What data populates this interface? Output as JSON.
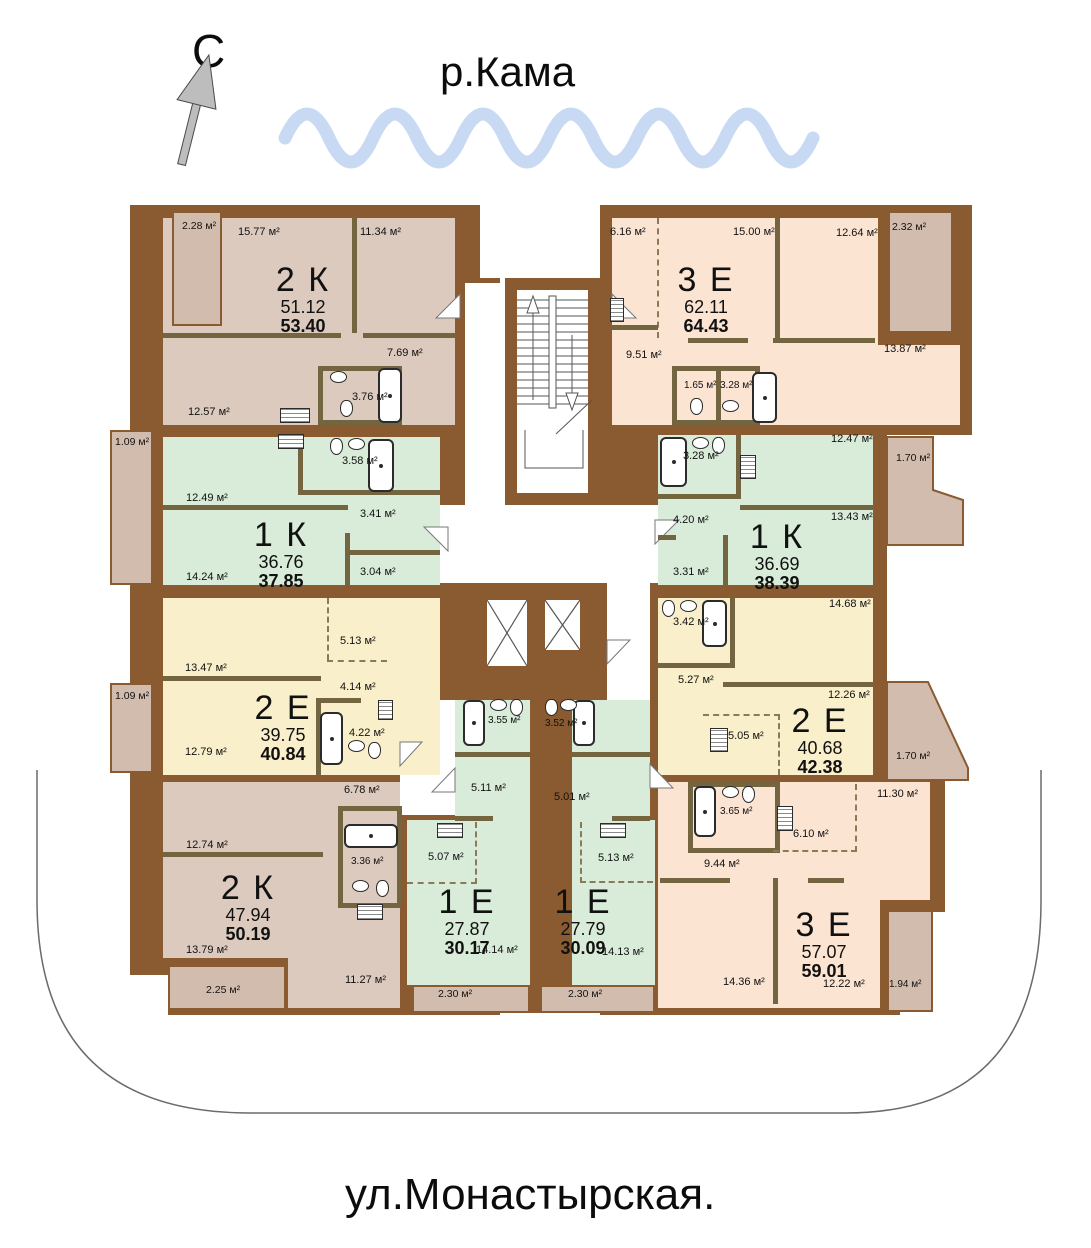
{
  "palette": {
    "wall_brown": "#8a5a30",
    "partition_olive": "#72653f",
    "fill_taupe": "#dccabf",
    "fill_peach": "#fce4d3",
    "fill_green": "#d8ecd9",
    "fill_yellow": "#f9efca",
    "balcony_taupe": "#d2bcae",
    "wave_blue": "#c7d9f3"
  },
  "annotations": {
    "north_letter": "С",
    "river_label": "р.Кама",
    "street_label": "ул.Монастырская."
  },
  "apartments": {
    "a1": {
      "type": "2 К",
      "living": "51.12",
      "total": "53.40",
      "rooms": {
        "r1": "15.77 м²",
        "r2": "11.34 м²",
        "hall": "12.57 м²",
        "corridor": "7.69 м²",
        "bath": "3.76 м²",
        "balcony": "2.28 м²"
      }
    },
    "b1": {
      "type": "3 Е",
      "living": "62.11",
      "total": "64.43",
      "rooms": {
        "r1": "6.16 м²",
        "r2": "15.00 м²",
        "r3": "12.64 м²",
        "hall": "9.51 м²",
        "r4": "13.87 м²",
        "wc": "1.65 м²",
        "bath": "3.28 м²",
        "balcony": "2.32 м²"
      }
    },
    "a2": {
      "type": "1 К",
      "living": "36.76",
      "total": "37.85",
      "rooms": {
        "kitchen": "12.49 м²",
        "bath": "3.58 м²",
        "hall": "3.41 м²",
        "room": "14.24 м²",
        "wc": "3.04 м²",
        "balcony": "1.09 м²"
      }
    },
    "b2": {
      "type": "1 К",
      "living": "36.69",
      "total": "38.39",
      "rooms": {
        "kitchen": "12.47 м²",
        "bath": "3.28 м²",
        "hall": "4.20 м²",
        "room": "13.43 м²",
        "wc": "3.31 м²",
        "balcony": "1.70 м²"
      }
    },
    "a3": {
      "type": "2 Е",
      "living": "39.75",
      "total": "40.84",
      "rooms": {
        "r1": "13.47 м²",
        "kitchen": "5.13 м²",
        "hall": "4.14 м²",
        "r2": "12.79 м²",
        "bath": "4.22 м²",
        "balcony": "1.09 м²"
      }
    },
    "b3": {
      "type": "2 Е",
      "living": "40.68",
      "total": "42.38",
      "rooms": {
        "r1": "14.68 м²",
        "bath": "3.42 м²",
        "hall": "5.27 м²",
        "r2": "12.26 м²",
        "kitchen": "5.05 м²",
        "balcony": "1.70 м²"
      }
    },
    "a4": {
      "type": "2 К",
      "living": "47.94",
      "total": "50.19",
      "rooms": {
        "r1": "12.74 м²",
        "corridor": "6.78 м²",
        "bath": "3.36 м²",
        "r2": "13.79 м²",
        "hall": "11.27 м²",
        "balcony": "2.25 м²"
      }
    },
    "e1": {
      "type": "1 Е",
      "living": "27.87",
      "total": "30.17",
      "rooms": {
        "bath": "3.55 м²",
        "corridor": "5.11 м²",
        "kitchen": "5.07 м²",
        "room": "14.14 м²",
        "balcony": "2.30 м²"
      }
    },
    "e2": {
      "type": "1 Е",
      "living": "27.79",
      "total": "30.09",
      "rooms": {
        "bath": "3.52 м²",
        "corridor": "5.01 м²",
        "kitchen": "5.13 м²",
        "room": "14.13 м²",
        "balcony": "2.30 м²"
      }
    },
    "b4": {
      "type": "3 Е",
      "living": "57.07",
      "total": "59.01",
      "rooms": {
        "r1": "11.30 м²",
        "kitchen": "6.10 м²",
        "bath": "3.65 м²",
        "hall": "9.44 м²",
        "r2": "14.36 м²",
        "r3": "12.22 м²",
        "balcony": "1.94 м²"
      }
    }
  }
}
